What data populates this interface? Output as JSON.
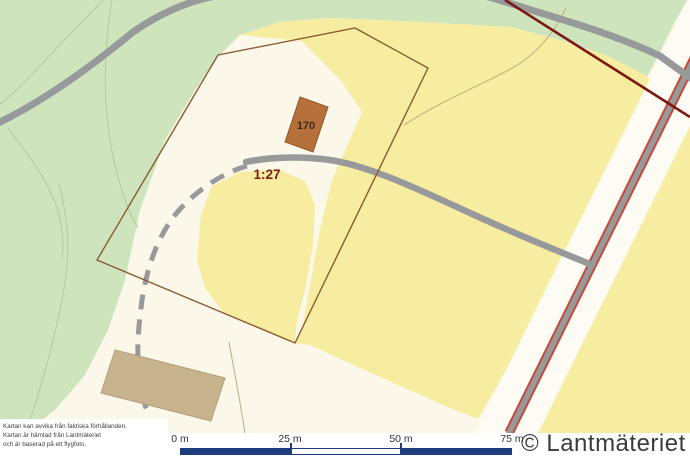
{
  "map": {
    "labels": {
      "building_number": "170",
      "parcel_id": "1:27"
    },
    "colors": {
      "map-cream": "#FBF8EA",
      "forest-green": "#CEE4BD",
      "parcel-yellow": "#F7EDA1",
      "corridor-white": "#FDFCF4",
      "road-gray": "#97999B",
      "road-red": "#C7493B",
      "boundary-brown": "#8C5B2F",
      "boundary-maroon": "#7C170E",
      "contour-green": "#B8CBA2",
      "contour-olive": "#BDB489",
      "building-fill": "#B5703C",
      "building-stroke": "#925526",
      "barn-fill": "#C7B38D",
      "barn-stroke": "#B2A07B",
      "label-red": "#7D1D17",
      "label-dark": "#3A2A1A",
      "scalebar-navy": "#1D3C7C",
      "footer-text": "#3B3B3B",
      "footer-bg": "#FFFFFF"
    }
  },
  "footer": {
    "disclaimer_lines": [
      "Kartan kan avvika från faktiska förhållanden.",
      "Kartan är hämtad från Lantmäteriet",
      "och är baserad på ett flygfoto."
    ],
    "scalebar": {
      "labels": [
        "0 m",
        "25 m",
        "50 m",
        "75 m"
      ]
    },
    "copyright": "© Lantmäteriet"
  }
}
